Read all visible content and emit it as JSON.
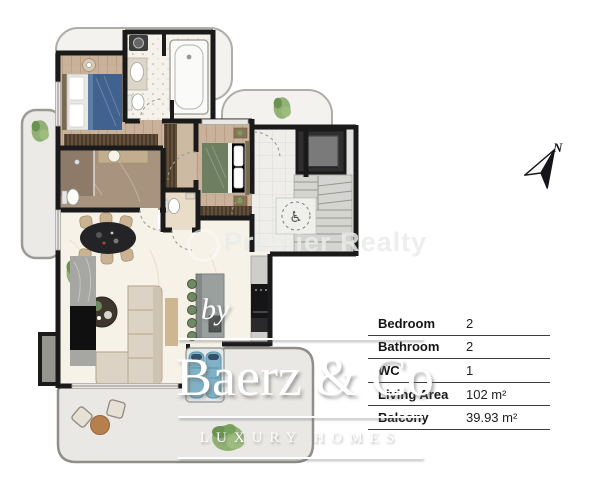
{
  "watermark": {
    "brand": "Premier Realty"
  },
  "compass": {
    "label": "N"
  },
  "logo": {
    "prefix": "by",
    "name": "Baerz & Co",
    "tagline": "LUXURY HOMES"
  },
  "details_table": {
    "rows": [
      {
        "label": "Bedroom",
        "value": "2"
      },
      {
        "label": "Bathroom",
        "value": "2"
      },
      {
        "label": "WC",
        "value": "1"
      },
      {
        "label": "Living Area",
        "value": "102 m²"
      },
      {
        "label": "Balcony",
        "value": "39.93 m²"
      }
    ]
  },
  "icons": {
    "wheelchair": "♿"
  },
  "colors": {
    "wall": "#1a1a1a",
    "wood_floor": "#c9b299",
    "marble_floor": "#f7f2e8",
    "bathroom_tile": "#a8937e",
    "balcony": "#e9e8e4",
    "bed_blue": "#41618f",
    "bed_green": "#6e7f61",
    "logo_white": "#ffffff",
    "table_divider": "#3d3d3d"
  }
}
